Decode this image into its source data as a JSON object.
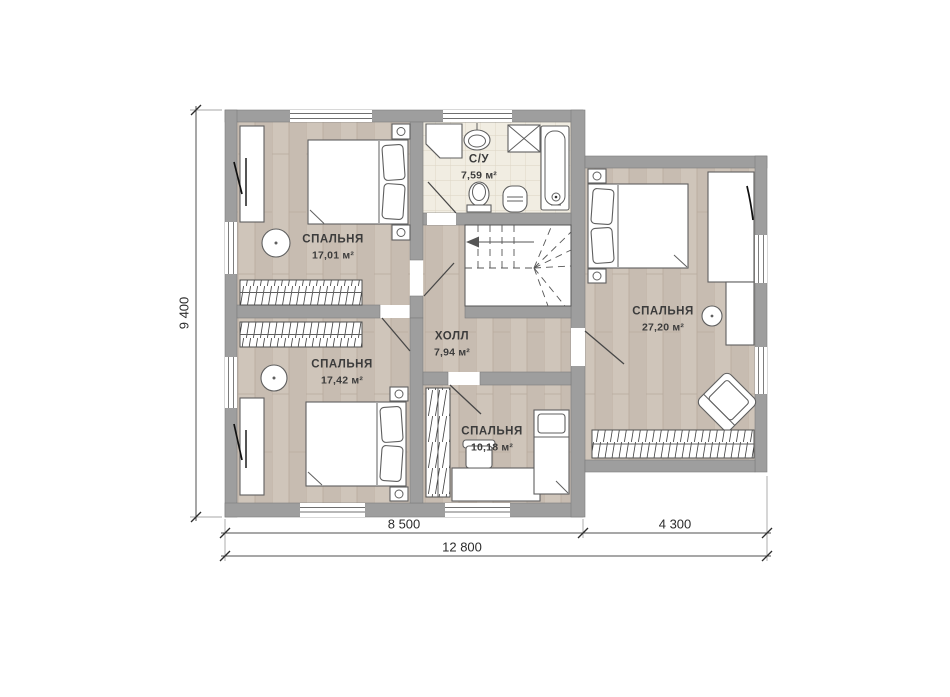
{
  "plan": {
    "rooms": [
      {
        "id": "bedroom-top-left",
        "name": "СПАЛЬНЯ",
        "area": "17,01 м²"
      },
      {
        "id": "bathroom",
        "name": "С/У",
        "area": "7,59 м²"
      },
      {
        "id": "bedroom-right",
        "name": "СПАЛЬНЯ",
        "area": "27,20 м²"
      },
      {
        "id": "hall",
        "name": "ХОЛЛ",
        "area": "7,94 м²"
      },
      {
        "id": "bedroom-bottom-left",
        "name": "СПАЛЬНЯ",
        "area": "17,42 м²"
      },
      {
        "id": "bedroom-bottom-middle",
        "name": "СПАЛЬНЯ",
        "area": "10,18 м²"
      }
    ],
    "dimensions": {
      "left_total": "9 400",
      "bottom_left": "8 500",
      "bottom_right": "4 300",
      "bottom_total": "12 800"
    },
    "colors": {
      "wall": "#9e9e9e",
      "wood1": "#cfc5ba",
      "wood2": "#c7bcb1",
      "woodline": "#b8ab9d",
      "tile": "#f1ede2",
      "tileline": "#dcd4c3",
      "ink": "#5f5f5f",
      "text": "#3c3c3c"
    }
  }
}
